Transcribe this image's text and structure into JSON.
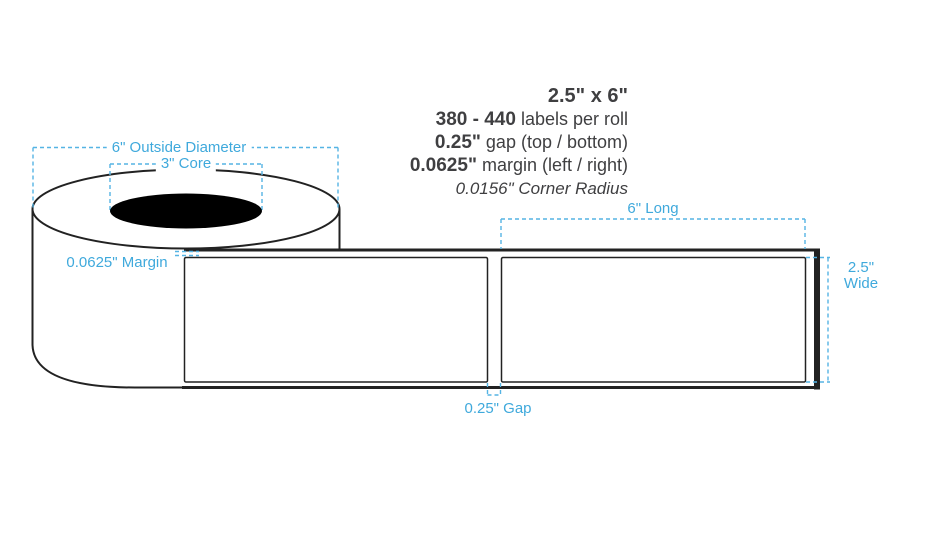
{
  "colors": {
    "accent_blue": "#3FA9DC",
    "dash_blue": "#55B4E4",
    "line_black": "#222222",
    "core_fill": "#000000"
  },
  "specs": {
    "size": "2.5\" x 6\"",
    "labels_per_roll_value": "380 - 440",
    "labels_per_roll_text": " labels per roll",
    "gap_value": "0.25\"",
    "gap_text": " gap (top / bottom)",
    "margin_value": "0.0625\"",
    "margin_text": " margin (left / right)",
    "corner_radius": "0.0156\" Corner Radius"
  },
  "dimensions": {
    "outside_diameter": "6\" Outside Diameter",
    "core": "3\" Core",
    "roll_margin": "0.0625\" Margin",
    "label_length": "6\" Long",
    "label_width_line1": "2.5\"",
    "label_width_line2": "Wide",
    "label_gap": "0.25\" Gap"
  }
}
